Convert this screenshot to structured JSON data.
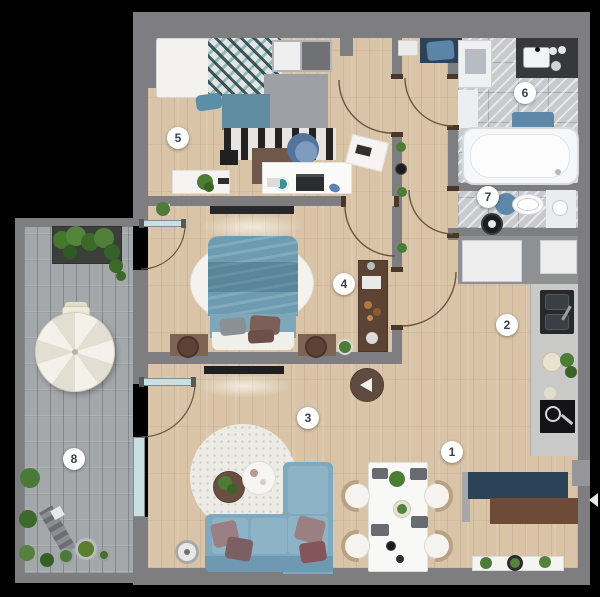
{
  "canvas": {
    "width": 600,
    "height": 597,
    "background": "#000000"
  },
  "palette": {
    "wood": "#d9c4a7",
    "wall": "#7e7e81",
    "marble": "#c7cbce",
    "shingle": "#a4a8ab",
    "glass": "#c9e0e3",
    "sofa": "#7fa9bf",
    "sofaCushion": "#8db3c7",
    "sofaBack": "#6f99b0",
    "bed": "#6d9cb0",
    "navy": "#2c4357",
    "brown": "#6e4a38",
    "green": "#4c7c36",
    "badgeBg": "#ffffff",
    "badgeText": "#3b4046"
  },
  "badges": [
    {
      "number": "1",
      "x": 452,
      "y": 452
    },
    {
      "number": "2",
      "x": 507,
      "y": 325
    },
    {
      "number": "3",
      "x": 308,
      "y": 418
    },
    {
      "number": "4",
      "x": 344,
      "y": 284
    },
    {
      "number": "5",
      "x": 178,
      "y": 138
    },
    {
      "number": "6",
      "x": 525,
      "y": 93
    },
    {
      "number": "7",
      "x": 488,
      "y": 197
    },
    {
      "number": "8",
      "x": 74,
      "y": 459
    }
  ]
}
